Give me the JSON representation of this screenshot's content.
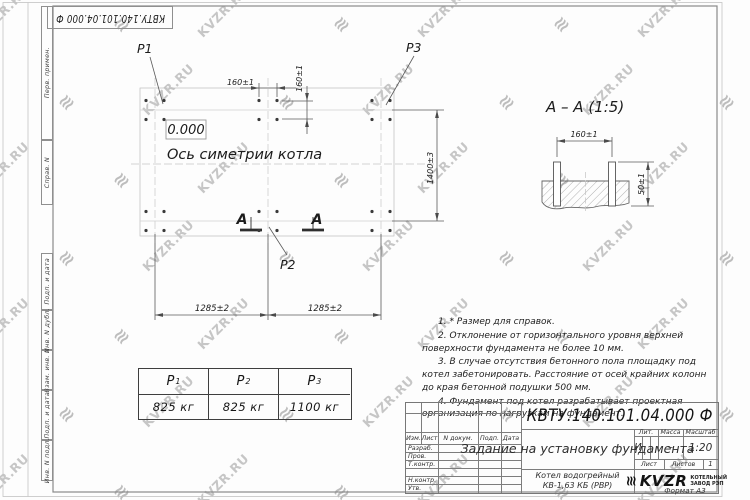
{
  "sheet": {
    "top_stamp": "КВТУ.140.101.04.000  Ф",
    "format_note": "Формат А3",
    "watermark_text": "KVZR.RU",
    "margin_labels_top": [
      "Перв. примен.",
      "Справ. N"
    ],
    "margin_labels_bottom": [
      "Подп. и дата",
      "Инв. N дубл.",
      "Взам. инв. N",
      "Подп. и дата",
      "Инв. N подл."
    ]
  },
  "plan": {
    "elevation": "0.000",
    "symmetry_axis_label": "Ось симетрии котла",
    "labels": {
      "p1": "P1",
      "p2": "P2",
      "p3": "P3"
    },
    "section_letter_left": "А",
    "section_letter_right": "А",
    "dim_bolt_horizontal": "160±1",
    "dim_bolt_vertical": "160±1",
    "dim_rows": "1400±3",
    "dim_span_left": "1285±2",
    "dim_span_right": "1285±2"
  },
  "section_view": {
    "title": "А – А (1:5)",
    "dim_width": "160±1",
    "dim_height": "50±1"
  },
  "notes": [
    "1. * Размер для справок.",
    "2. Отклонение от горизонтального уровня верхней поверхности фундамента не более 10 мм.",
    "3. В случае отсутствия бетонного пола площадку под котел забетонировать. Расстояние от осей крайних колонн до края бетонной подушки 500 мм.",
    "4. Фундамент под котел разрабатывает проектная организация по нагрузкам на фундамент."
  ],
  "load_table": {
    "columns": [
      {
        "name": "P",
        "sub": "1",
        "value": "825 кг"
      },
      {
        "name": "P",
        "sub": "2",
        "value": "825 кг"
      },
      {
        "name": "P",
        "sub": "3",
        "value": "1100 кг"
      }
    ]
  },
  "title_block": {
    "designation": "КВТУ.140.101.04.000  Ф",
    "document_title": "Задание на установку фундамента",
    "product_line1": "Котел водогрейный",
    "product_line2": "КВ-1,63 КБ (РВР)",
    "header_cells": [
      "Изм.",
      "Лист",
      "N докум.",
      "Подп.",
      "Дата"
    ],
    "signature_rows": [
      "Разраб.",
      "Пров.",
      "Т.контр.",
      "Н.контр.",
      "Утв."
    ],
    "liter_label": "Лит.",
    "liter_value": "И",
    "mass_label": "Масса",
    "mass_value": "–",
    "scale_label": "Масштаб",
    "scale_value": "1:20",
    "sheet_label": "Лист",
    "sheets_label": "Листов",
    "sheets_value": "1",
    "logo_text": "KVZR",
    "company_line1": "КОТЕЛЬНЫЙ",
    "company_line2": "ЗАВОД РЭП"
  }
}
